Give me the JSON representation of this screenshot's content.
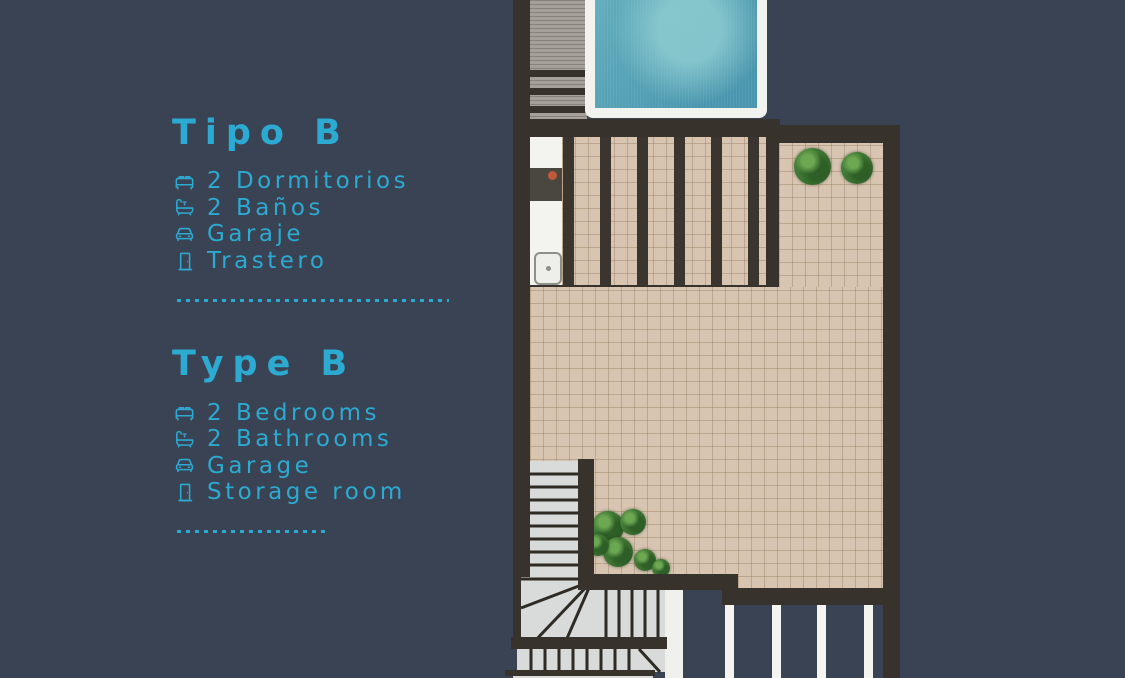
{
  "palette": {
    "background": "#3a4353",
    "accent_cyan": "#2caad2",
    "wall_dark": "#37322b",
    "tile_beige": "#d7c5b1",
    "stair_gray": "#d8dbd9",
    "deck_gray": "#a5a09a",
    "pool_teal": "#4a96ae",
    "pool_light": "#8ac9cf",
    "plant_green": "#46823a",
    "surface_white": "#f3f3f0"
  },
  "legend": {
    "spanish": {
      "title": "Tipo B",
      "items": [
        {
          "icon": "bed-icon",
          "label": "2 Dormitorios"
        },
        {
          "icon": "bathtub-icon",
          "label": "2 Baños"
        },
        {
          "icon": "car-icon",
          "label": "Garaje"
        },
        {
          "icon": "door-icon",
          "label": "Trastero"
        }
      ]
    },
    "english": {
      "title": "Type B",
      "items": [
        {
          "icon": "bed-icon",
          "label": "2 Bedrooms"
        },
        {
          "icon": "bathtub-icon",
          "label": "2 Bathrooms"
        },
        {
          "icon": "car-icon",
          "label": "Garage"
        },
        {
          "icon": "door-icon",
          "label": "Storage room"
        }
      ]
    }
  },
  "floorplan": {
    "features": [
      "swimming-pool",
      "wood-deck",
      "pergola-terrace",
      "outdoor-kitchen-counter",
      "roof-terrace",
      "potted-plants",
      "staircase",
      "railing"
    ]
  }
}
